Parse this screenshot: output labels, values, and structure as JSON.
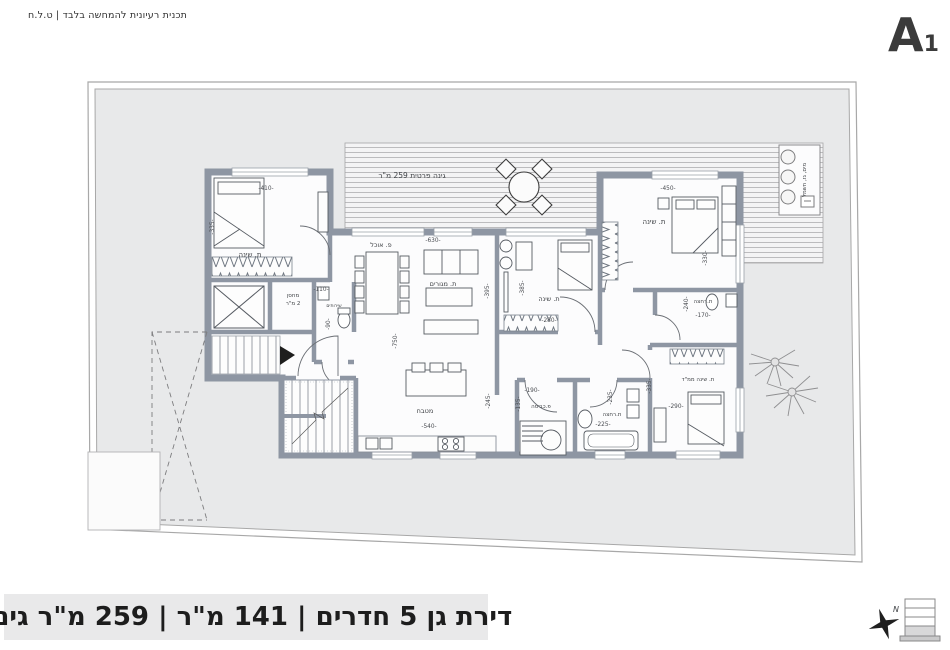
{
  "header": {
    "disclaimer": "תכנית רעיונית להמחשה בלבד | ט.ל.ח",
    "sheet_letter": "A",
    "sheet_number": "1"
  },
  "footer": {
    "title": "דירת גן 5 חדרים | 141 מ\"ר | 259 מ\"ר גינה",
    "north_label": "N"
  },
  "plan": {
    "garden_label": "גינה פרטית  259  מ\"ר",
    "utilities_label": "מים, גז, חשמל",
    "room_labels": [
      {
        "t": "ת. שינה",
        "x": 250,
        "y": 257,
        "s": 7
      },
      {
        "t": "מחסן",
        "x": 293,
        "y": 297,
        "s": 5.5
      },
      {
        "t": "2 מ\"ר",
        "x": 293,
        "y": 305,
        "s": 5.5
      },
      {
        "t": "שירותים",
        "x": 334,
        "y": 307,
        "s": 4.6
      },
      {
        "t": "פ. אוכל",
        "x": 381,
        "y": 247,
        "s": 6.5
      },
      {
        "t": "ת. מגורים",
        "x": 443,
        "y": 286,
        "s": 6.5
      },
      {
        "t": "מטבח",
        "x": 425,
        "y": 413,
        "s": 6.5
      },
      {
        "t": "ת. שינה",
        "x": 549,
        "y": 301,
        "s": 6.5
      },
      {
        "t": "ת. שינה",
        "x": 654,
        "y": 224,
        "s": 7
      },
      {
        "t": "ת.רחצה",
        "x": 703,
        "y": 303,
        "s": 5.5
      },
      {
        "t": "ת. שינה ממ\"ד",
        "x": 698,
        "y": 381,
        "s": 5.5
      },
      {
        "t": "ת.רחצה",
        "x": 612,
        "y": 416,
        "s": 5.5
      },
      {
        "t": "פ.כביסה",
        "x": 541,
        "y": 408,
        "s": 5.5
      }
    ],
    "dimension_labels": [
      {
        "t": "-410-",
        "x": 266,
        "y": 190
      },
      {
        "t": "-335-",
        "x": 214,
        "y": 227,
        "r": -90
      },
      {
        "t": "-110-",
        "x": 321,
        "y": 291
      },
      {
        "t": "-90-",
        "x": 330,
        "y": 324,
        "r": -90
      },
      {
        "t": "-630-",
        "x": 433,
        "y": 242
      },
      {
        "t": "-750-",
        "x": 397,
        "y": 341,
        "r": -90
      },
      {
        "t": "-395-",
        "x": 489,
        "y": 291,
        "r": -90
      },
      {
        "t": "-385-",
        "x": 524,
        "y": 288,
        "r": -90
      },
      {
        "t": "-280-",
        "x": 549,
        "y": 322
      },
      {
        "t": "-450-",
        "x": 668,
        "y": 190
      },
      {
        "t": "-330-",
        "x": 707,
        "y": 258,
        "r": -90
      },
      {
        "t": "-240-",
        "x": 688,
        "y": 304,
        "r": -90
      },
      {
        "t": "-170-",
        "x": 703,
        "y": 317
      },
      {
        "t": "-540-",
        "x": 429,
        "y": 428
      },
      {
        "t": "-245-",
        "x": 490,
        "y": 401,
        "r": -90
      },
      {
        "t": "-190-",
        "x": 532,
        "y": 392
      },
      {
        "t": "-135-",
        "x": 520,
        "y": 404,
        "r": -90
      },
      {
        "t": "-235-",
        "x": 612,
        "y": 397,
        "r": -90
      },
      {
        "t": "-225-",
        "x": 603,
        "y": 426
      },
      {
        "t": "-290-",
        "x": 676,
        "y": 408
      },
      {
        "t": "-335-",
        "x": 651,
        "y": 386,
        "r": -90
      }
    ]
  },
  "colors": {
    "wall": "#8e96a3",
    "plot_fill": "#e8e9ea",
    "deck_fill": "#f4f4f5",
    "deck_line": "#b6b6b8",
    "title_bg": "#e9e9ea"
  }
}
